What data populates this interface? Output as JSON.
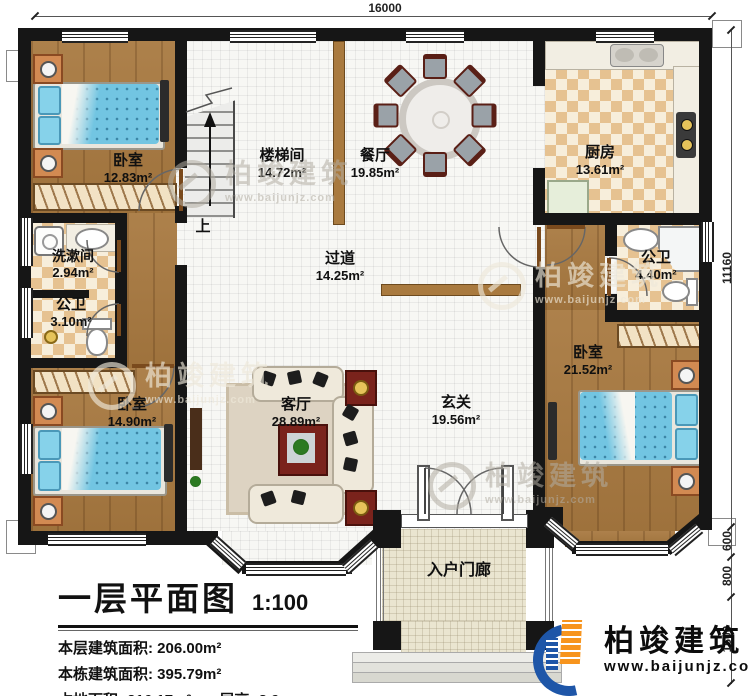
{
  "dimensions": {
    "top": "16000",
    "right": [
      "11160",
      "600",
      "800",
      "1600"
    ]
  },
  "rooms": {
    "bedroom_tl": {
      "name": "卧室",
      "area": "12.83m²"
    },
    "stairwell": {
      "name": "楼梯间",
      "area": "14.72m²"
    },
    "dining": {
      "name": "餐厅",
      "area": "19.85m²"
    },
    "kitchen": {
      "name": "厨房",
      "area": "13.61m²"
    },
    "washroom": {
      "name": "洗漱间",
      "area": "2.94m²"
    },
    "toilet_left": {
      "name": "公卫",
      "area": "3.10m²"
    },
    "corridor": {
      "name": "过道",
      "area": "14.25m²"
    },
    "bath_right": {
      "name": "公卫",
      "area": "4.40m²"
    },
    "bedroom_bl": {
      "name": "卧室",
      "area": "14.90m²"
    },
    "living": {
      "name": "客厅",
      "area": "28.89m²"
    },
    "foyer": {
      "name": "玄关",
      "area": "19.56m²"
    },
    "bedroom_r": {
      "name": "卧室",
      "area": "21.52m²"
    },
    "porch": {
      "name": "入户门廊"
    }
  },
  "stairs": {
    "up": "上"
  },
  "title_block": {
    "title": "一层平面图",
    "scale": "1:100",
    "rows": [
      {
        "label": "本层建筑面积:",
        "value": "206.00m²"
      },
      {
        "label": "本栋建筑面积:",
        "value": "395.79m²"
      },
      {
        "label": "占地面积:",
        "value": "216.17m²"
      },
      {
        "label": "层高:",
        "value": "3.9m"
      }
    ]
  },
  "brand": {
    "name": "柏竣建筑",
    "url": "www.baijunjz.com"
  },
  "watermark": {
    "name": "柏竣建筑",
    "url": "www.baijunjz.com"
  },
  "colors": {
    "wall": "#161616",
    "wood": "#a87940",
    "bed_blue": "#72c5e2",
    "checker_tan": "#e6c291",
    "brand_blue": "#1e56a8",
    "brand_orange": "#f7941d"
  }
}
